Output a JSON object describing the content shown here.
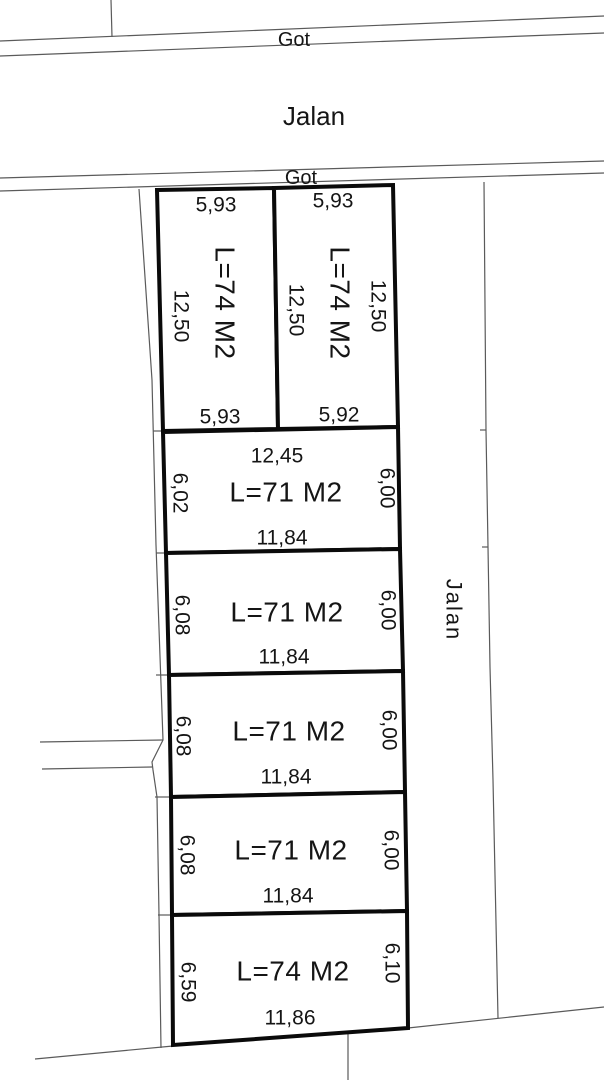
{
  "drawing": {
    "roads": {
      "got_top": "Got",
      "jalan_top": "Jalan",
      "got_mid": "Got",
      "jalan_right": "Jalan"
    },
    "plots": [
      {
        "name": "plot-1",
        "area": "L=74 M2",
        "width_top": "5,93",
        "width_bottom": "5,93",
        "depth_left": "12,50"
      },
      {
        "name": "plot-2",
        "area": "L=74 M2",
        "width_top": "5,93",
        "width_bottom": "5,92",
        "depth_left": "12,50",
        "depth_right": "12,50"
      },
      {
        "name": "plot-3",
        "area": "L=71 M2",
        "width_top": "12,45",
        "width_bottom": "11,84",
        "depth_left": "6,02",
        "depth_right": "6,00"
      },
      {
        "name": "plot-4",
        "area": "L=71 M2",
        "width_bottom": "11,84",
        "depth_left": "6,08",
        "depth_right": "6,00"
      },
      {
        "name": "plot-5",
        "area": "L=71 M2",
        "width_bottom": "11,84",
        "depth_left": "6,08",
        "depth_right": "6,00"
      },
      {
        "name": "plot-6",
        "area": "L=71 M2",
        "width_bottom": "11,84",
        "depth_left": "6,08",
        "depth_right": "6,00"
      },
      {
        "name": "plot-7",
        "area": "L=74 M2",
        "width_bottom": "11,86",
        "depth_left": "6,59",
        "depth_right": "6,10"
      }
    ],
    "colors": {
      "background": "#ffffff",
      "thin_line": "#5a5a5a",
      "thick_line": "#0a0a0a",
      "text": "#151515"
    }
  }
}
